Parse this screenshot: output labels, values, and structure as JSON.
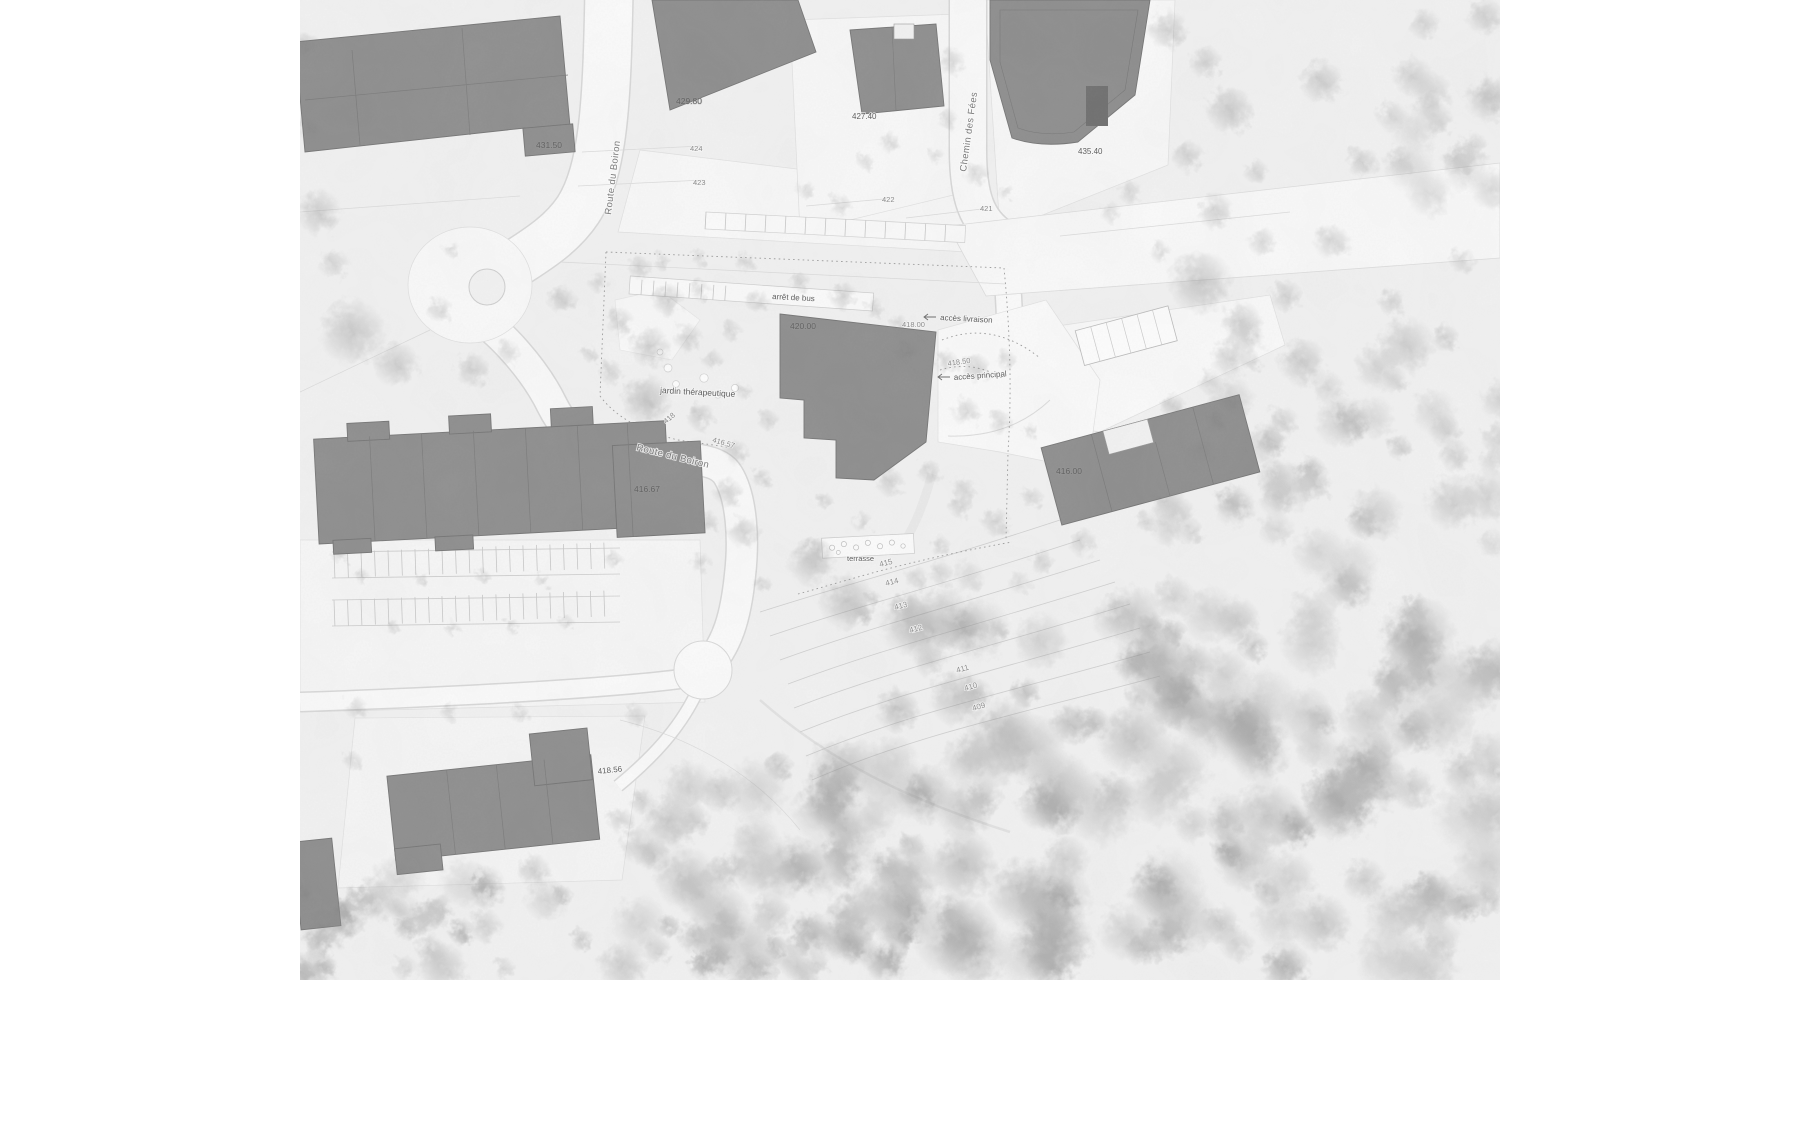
{
  "map": {
    "title": "architectural site plan (greyscale)",
    "streets": {
      "boiron_v": "Route du Boiron",
      "boiron_c": "Route du Boiron",
      "fees": "Chemin des Fées"
    },
    "annotations": {
      "bus": "arrêt de bus",
      "livraison": "accès livraison",
      "principal": "accès principal",
      "jardin": "jardin thérapeutique",
      "terrasse": "terrasse"
    },
    "elevations": {
      "bldgA": "431.50",
      "bldgB": "429.80",
      "bldgC": "427.40",
      "bldgD": "435.40",
      "main": "420.00",
      "east": "416.00",
      "slab": "416.67",
      "south": "418.56"
    },
    "spots": {
      "court": "418.00",
      "drive": "418.50",
      "g418": "418",
      "g41657": "416.57",
      "h424": "424",
      "h423": "423",
      "h422": "422",
      "h421": "421"
    },
    "contours": [
      "415",
      "414",
      "413",
      "412",
      "411",
      "410",
      "409"
    ],
    "colors": {
      "building": "#8d8d8d",
      "building_edge": "#737373",
      "ground": "#f3f3f3",
      "road": "#fcfcfc",
      "road_casing": "#d9d9d9",
      "contour_line": "#d0d0d0",
      "label_text": "#5d5d5d"
    },
    "trees": [
      [
        318,
        212,
        24,
        0.4
      ],
      [
        305,
        48,
        18,
        0.35
      ],
      [
        352,
        332,
        34,
        0.45
      ],
      [
        396,
        364,
        24,
        0.4
      ],
      [
        440,
        310,
        14,
        0.35
      ],
      [
        334,
        264,
        16,
        0.3
      ],
      [
        472,
        370,
        18,
        0.38
      ],
      [
        508,
        352,
        13,
        0.3
      ],
      [
        452,
        250,
        9,
        0.3
      ],
      [
        310,
        128,
        14,
        0.3
      ],
      [
        562,
        300,
        15,
        0.38
      ],
      [
        598,
        282,
        11,
        0.3
      ],
      [
        640,
        268,
        13,
        0.35
      ],
      [
        668,
        300,
        17,
        0.42
      ],
      [
        700,
        290,
        11,
        0.3
      ],
      [
        620,
        322,
        15,
        0.35
      ],
      [
        650,
        347,
        21,
        0.45
      ],
      [
        688,
        338,
        15,
        0.38
      ],
      [
        730,
        330,
        11,
        0.3
      ],
      [
        758,
        302,
        13,
        0.32
      ],
      [
        610,
        372,
        13,
        0.32
      ],
      [
        646,
        400,
        26,
        0.5
      ],
      [
        700,
        416,
        15,
        0.4
      ],
      [
        712,
        360,
        11,
        0.3
      ],
      [
        745,
        392,
        9,
        0.28
      ],
      [
        768,
        420,
        11,
        0.3
      ],
      [
        590,
        354,
        9,
        0.28
      ],
      [
        662,
        262,
        9,
        0.3
      ],
      [
        700,
        258,
        9,
        0.28
      ],
      [
        745,
        262,
        11,
        0.3
      ],
      [
        800,
        282,
        11,
        0.32
      ],
      [
        843,
        296,
        15,
        0.4
      ],
      [
        874,
        308,
        11,
        0.3
      ],
      [
        906,
        352,
        21,
        0.45
      ],
      [
        946,
        362,
        13,
        0.35
      ],
      [
        976,
        368,
        15,
        0.38
      ],
      [
        1006,
        360,
        11,
        0.3
      ],
      [
        898,
        322,
        9,
        0.28
      ],
      [
        966,
        412,
        15,
        0.36
      ],
      [
        1000,
        422,
        13,
        0.32
      ],
      [
        1032,
        432,
        9,
        0.28
      ],
      [
        736,
        452,
        13,
        0.35
      ],
      [
        762,
        478,
        11,
        0.3
      ],
      [
        728,
        492,
        15,
        0.38
      ],
      [
        706,
        522,
        13,
        0.33
      ],
      [
        744,
        532,
        17,
        0.4
      ],
      [
        700,
        562,
        11,
        0.3
      ],
      [
        812,
        562,
        25,
        0.45
      ],
      [
        848,
        602,
        29,
        0.5
      ],
      [
        890,
        482,
        15,
        0.35
      ],
      [
        930,
        472,
        13,
        0.32
      ],
      [
        862,
        522,
        11,
        0.3
      ],
      [
        960,
        506,
        13,
        0.33
      ],
      [
        996,
        522,
        15,
        0.36
      ],
      [
        940,
        546,
        11,
        0.3
      ],
      [
        1032,
        498,
        12,
        0.3
      ],
      [
        1168,
        30,
        21,
        0.42
      ],
      [
        1205,
        62,
        17,
        0.38
      ],
      [
        1230,
        110,
        25,
        0.45
      ],
      [
        1188,
        156,
        17,
        0.36
      ],
      [
        1256,
        172,
        13,
        0.32
      ],
      [
        1216,
        212,
        19,
        0.4
      ],
      [
        1262,
        242,
        15,
        0.35
      ],
      [
        1200,
        282,
        33,
        0.5
      ],
      [
        1242,
        322,
        21,
        0.42
      ],
      [
        1286,
        296,
        17,
        0.36
      ],
      [
        1160,
        252,
        11,
        0.3
      ],
      [
        1130,
        192,
        13,
        0.3
      ],
      [
        1110,
        212,
        11,
        0.28
      ],
      [
        952,
        62,
        15,
        0.34
      ],
      [
        948,
        120,
        11,
        0.3
      ],
      [
        976,
        174,
        13,
        0.32
      ],
      [
        1006,
        192,
        9,
        0.28
      ],
      [
        936,
        156,
        9,
        0.26
      ],
      [
        890,
        142,
        11,
        0.3
      ],
      [
        866,
        162,
        9,
        0.27
      ],
      [
        806,
        190,
        10,
        0.28
      ],
      [
        840,
        205,
        12,
        0.3
      ],
      [
        1322,
        82,
        23,
        0.4
      ],
      [
        1362,
        162,
        17,
        0.36
      ],
      [
        1332,
        242,
        19,
        0.38
      ],
      [
        1392,
        302,
        15,
        0.34
      ],
      [
        1302,
        362,
        25,
        0.44
      ],
      [
        1352,
        422,
        19,
        0.38
      ],
      [
        1396,
        382,
        13,
        0.3
      ],
      [
        1282,
        422,
        17,
        0.36
      ],
      [
        1312,
        482,
        21,
        0.4
      ],
      [
        1362,
        522,
        17,
        0.36
      ],
      [
        1210,
        382,
        13,
        0.32
      ],
      [
        1252,
        362,
        11,
        0.3
      ],
      [
        1272,
        442,
        15,
        0.34
      ],
      [
        1232,
        502,
        17,
        0.36
      ],
      [
        1192,
        532,
        13,
        0.32
      ],
      [
        1146,
        522,
        11,
        0.3
      ],
      [
        1082,
        542,
        15,
        0.34
      ],
      [
        1042,
        562,
        13,
        0.32
      ],
      [
        1438,
        120,
        16,
        0.33
      ],
      [
        1462,
        260,
        14,
        0.3
      ],
      [
        1445,
        430,
        18,
        0.36
      ],
      [
        362,
        576,
        8,
        0.3
      ],
      [
        422,
        580,
        8,
        0.3
      ],
      [
        482,
        576,
        8,
        0.3
      ],
      [
        542,
        580,
        8,
        0.3
      ],
      [
        392,
        626,
        8,
        0.3
      ],
      [
        452,
        628,
        8,
        0.3
      ],
      [
        512,
        626,
        8,
        0.3
      ],
      [
        566,
        622,
        8,
        0.3
      ],
      [
        340,
        556,
        9,
        0.3
      ],
      [
        614,
        560,
        9,
        0.3
      ],
      [
        356,
        708,
        12,
        0.3
      ],
      [
        450,
        712,
        10,
        0.28
      ],
      [
        520,
        714,
        10,
        0.28
      ],
      [
        636,
        716,
        12,
        0.3
      ],
      [
        352,
        760,
        10,
        0.28
      ],
      [
        620,
        820,
        14,
        0.34
      ],
      [
        360,
        900,
        16,
        0.36
      ],
      [
        440,
        906,
        14,
        0.33
      ]
    ],
    "forest_patches": [
      [
        886,
        610,
        614,
        360,
        130,
        14,
        40,
        0.3,
        0.55
      ],
      [
        620,
        760,
        300,
        210,
        55,
        12,
        34,
        0.3,
        0.5
      ],
      [
        300,
        868,
        330,
        105,
        32,
        10,
        28,
        0.28,
        0.45
      ],
      [
        1160,
        336,
        340,
        280,
        40,
        12,
        30,
        0.25,
        0.42
      ],
      [
        760,
        480,
        320,
        150,
        14,
        8,
        18,
        0.2,
        0.32
      ],
      [
        1390,
        0,
        110,
        210,
        16,
        12,
        26,
        0.25,
        0.4
      ],
      [
        700,
        920,
        220,
        60,
        18,
        10,
        22,
        0.3,
        0.45
      ]
    ],
    "parking_grids": [
      {
        "x": 334,
        "y": 552,
        "n": 21,
        "dx": 13.5,
        "len": 26,
        "rot": -2,
        "cx": 334,
        "cy": 552
      },
      {
        "x": 334,
        "y": 600,
        "n": 21,
        "dx": 13.5,
        "len": 26,
        "rot": -2,
        "cx": 334,
        "cy": 600
      },
      {
        "x": 642,
        "y": 279,
        "n": 8,
        "dx": 12,
        "len": 15,
        "rot": 4,
        "cx": 630,
        "cy": 280
      },
      {
        "x": 706,
        "y": 212,
        "n": 13,
        "dx": 20,
        "len": 17,
        "rot": 3,
        "cx": 706,
        "cy": 212
      }
    ]
  }
}
